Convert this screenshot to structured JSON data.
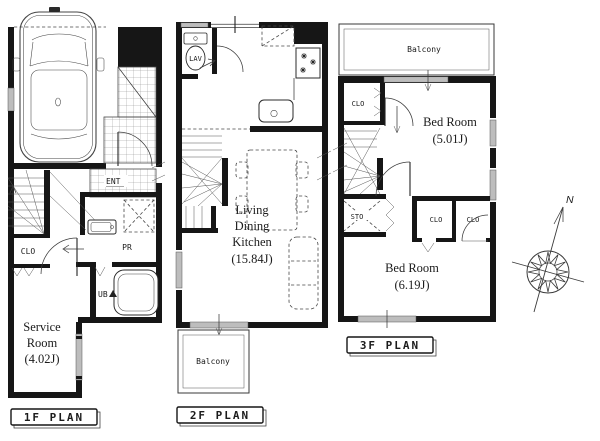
{
  "colors": {
    "wall": "#161616",
    "window_fill": "#bdbdbd",
    "background": "#ffffff"
  },
  "compass": {
    "north": "N"
  },
  "floor1": {
    "plan_label": "1F PLAN",
    "entrance": "ENT",
    "closet": "CLO",
    "powder_room": "PR",
    "unit_bath": "UB",
    "service_room": {
      "lines": [
        "Service",
        "Room",
        "(4.02J)"
      ]
    }
  },
  "floor2": {
    "plan_label": "2F PLAN",
    "lavatory": "LAV",
    "ldk": {
      "lines": [
        "Living",
        "Dining",
        "Kitchen",
        "(15.84J)"
      ]
    },
    "balcony": "Balcony"
  },
  "floor3": {
    "plan_label": "3F PLAN",
    "balcony": "Balcony",
    "closet_upper": "CLO",
    "bedroom_upper": {
      "lines": [
        "Bed Room",
        "(5.01J)"
      ]
    },
    "storage": "STO",
    "closet_left": "CLO",
    "closet_right": "CLO",
    "bedroom_lower": {
      "lines": [
        "Bed Room",
        "(6.19J)"
      ]
    }
  }
}
